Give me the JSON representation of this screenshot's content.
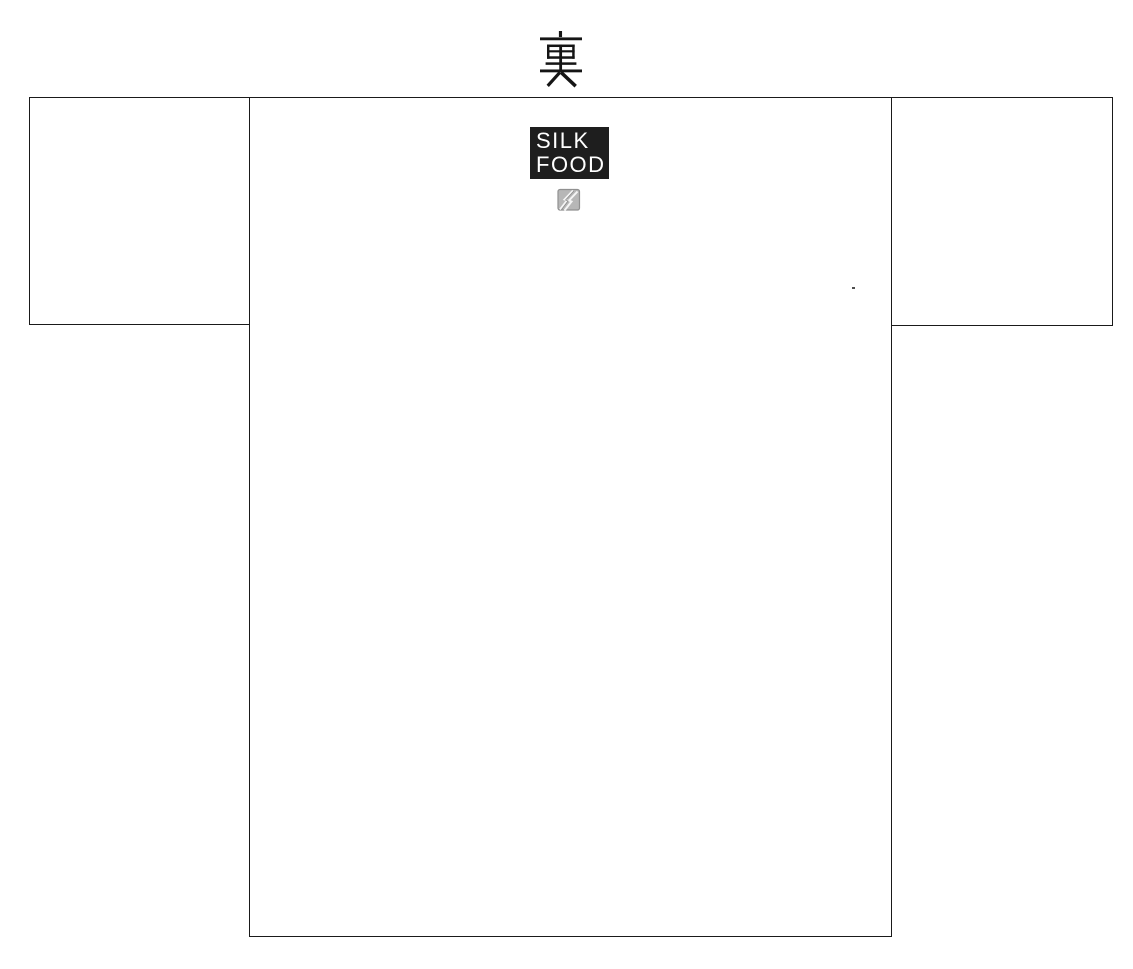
{
  "header": {
    "title": "裏"
  },
  "shirt": {
    "view": "back",
    "logo": {
      "line1": "SILK",
      "line2": "FOOD"
    },
    "brand_icon": "fragment-lightning-icon"
  },
  "colors": {
    "background": "#ffffff",
    "outline": "#1a1a1a",
    "logo_bg": "#1e1e1e",
    "logo_text": "#ffffff",
    "icon_fill": "#b7b7b7",
    "icon_stroke": "#909090",
    "icon_bolt": "#f5f5f5",
    "title_ink": "#151515",
    "speck": "#4f4f4f"
  }
}
